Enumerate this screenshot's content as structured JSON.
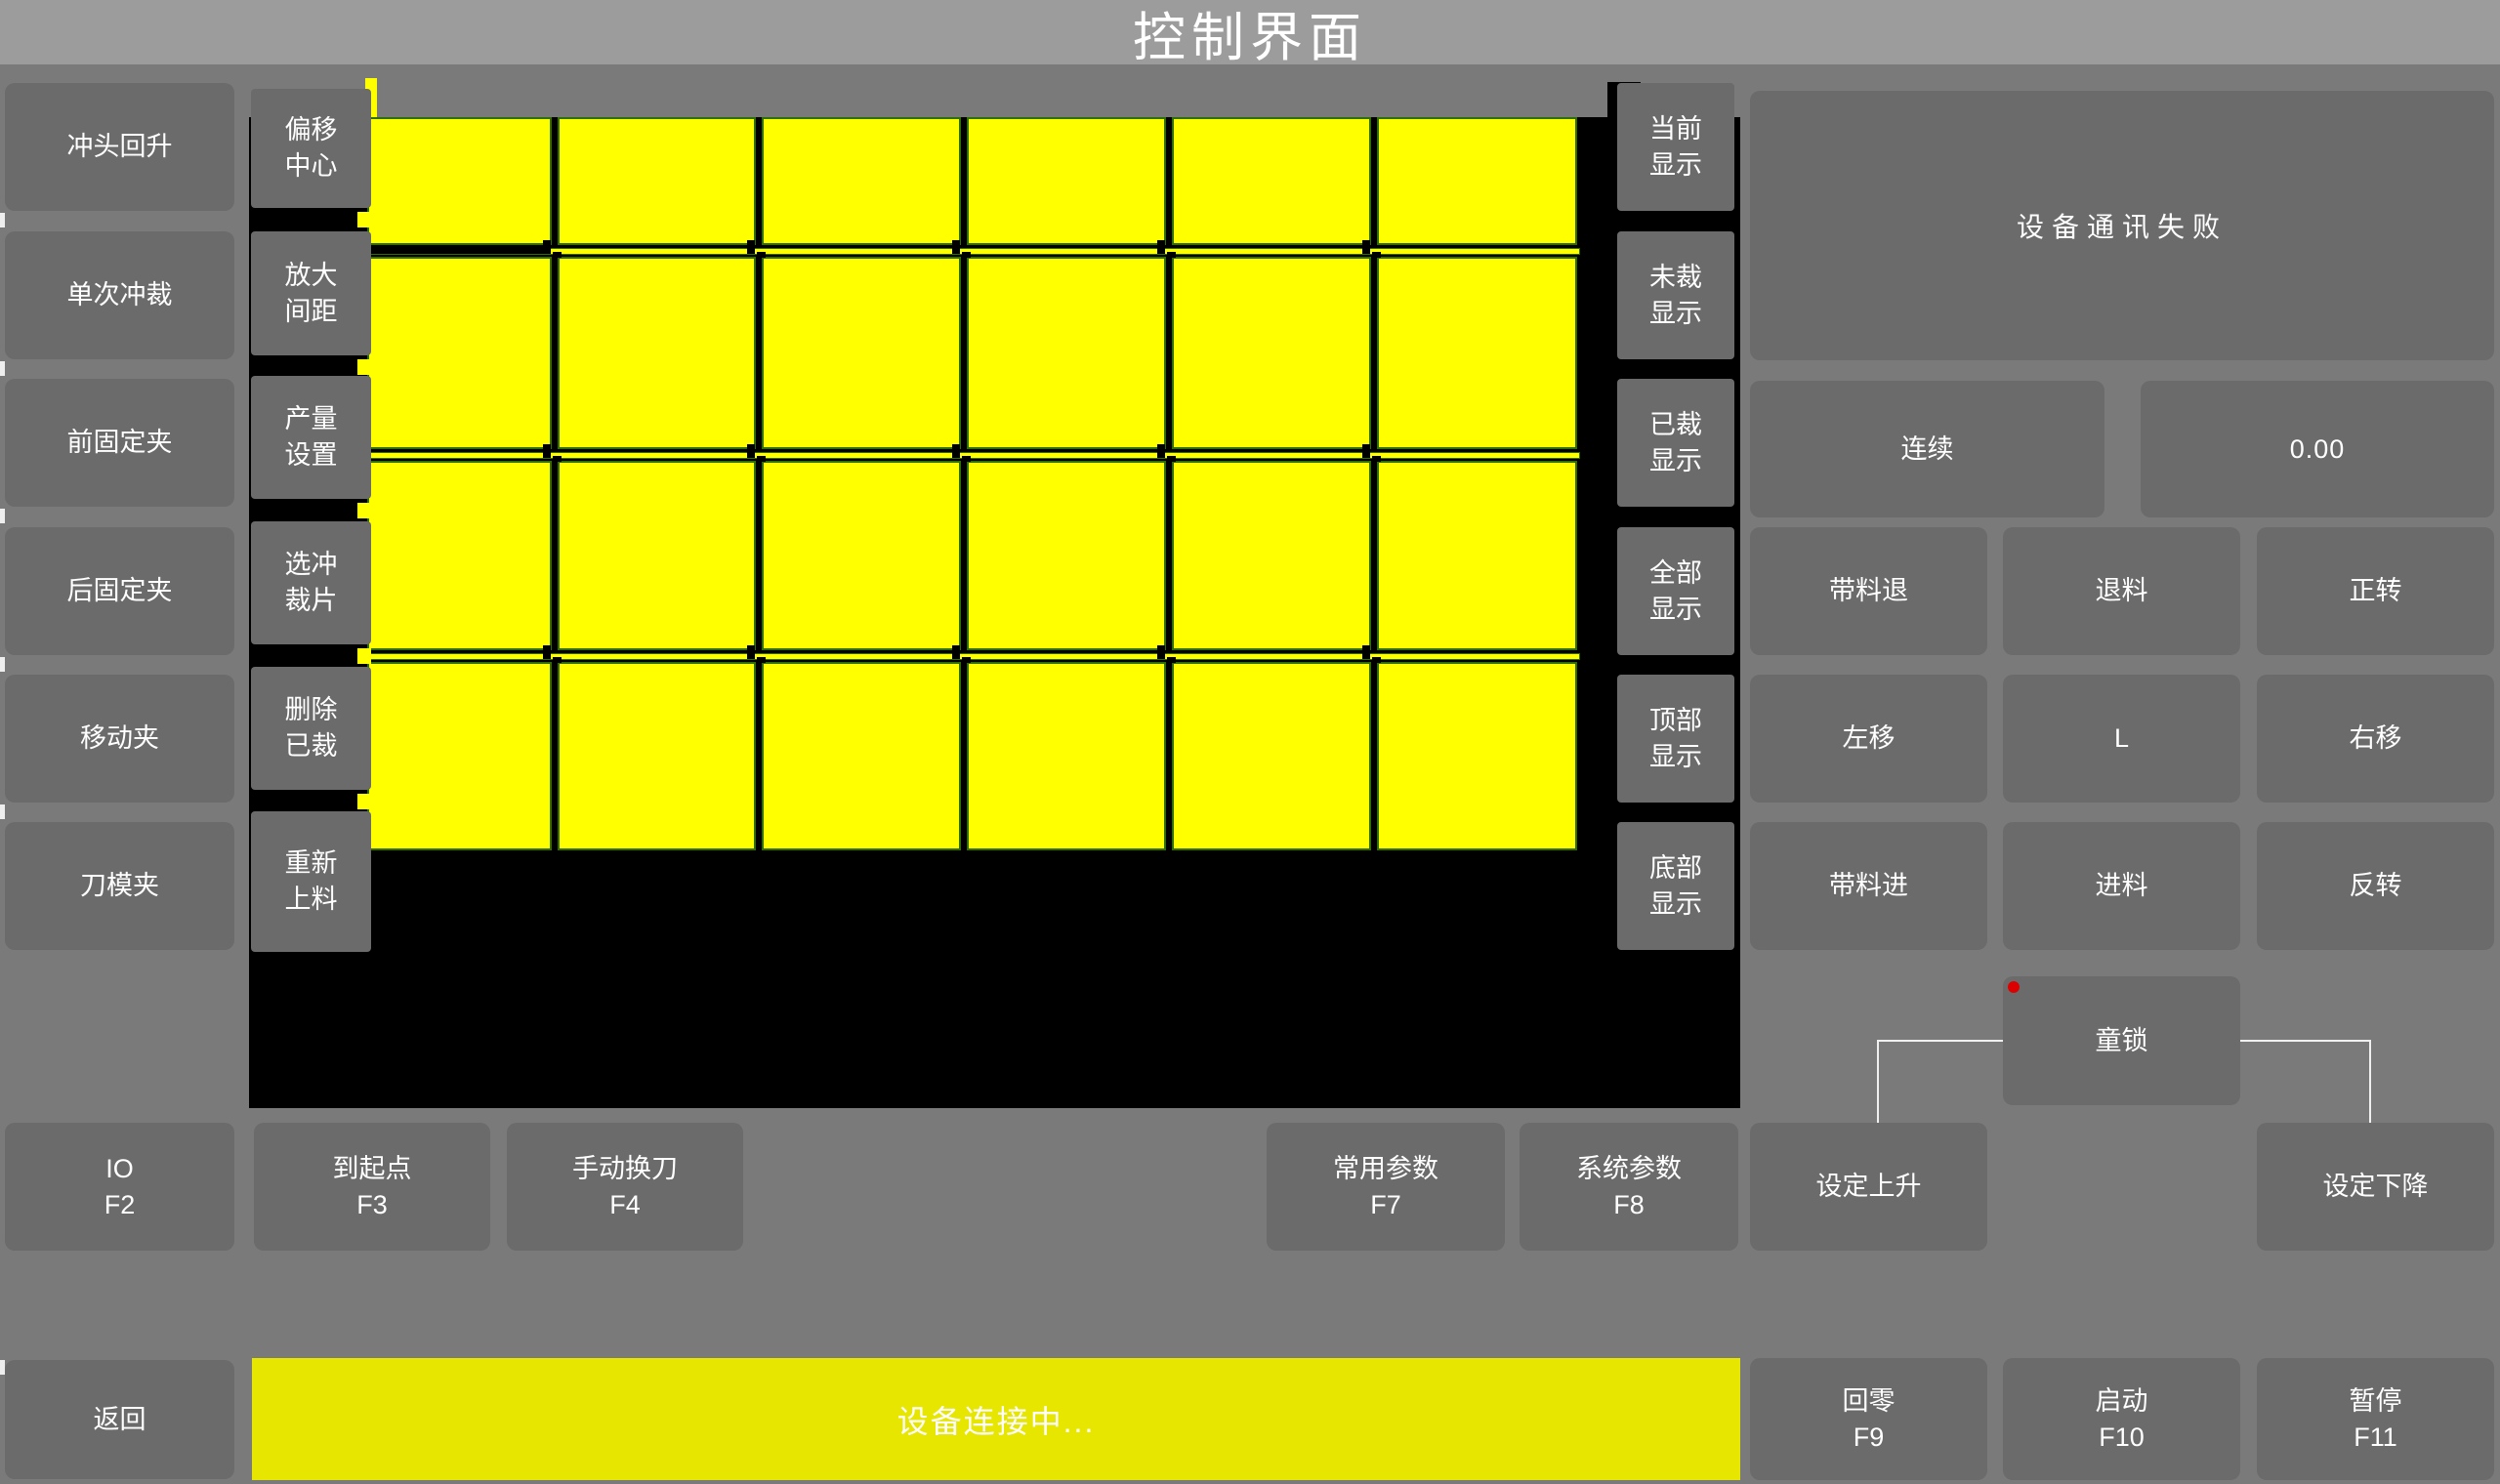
{
  "title": "控制界面",
  "colors": {
    "page": "#7a7a7a",
    "titlebar": "#9c9c9c",
    "button": "#6b6b6b",
    "sheet": "#000000",
    "piece_yellow": "#ffff00",
    "piece_border_green": "#2f6e00",
    "status_bar_yellow": "#e6e600",
    "red_dot": "#dd0000",
    "indicator_gray": "#b8b8b8",
    "bracket_white": "#f0f0f0",
    "text_white": "#ffffff"
  },
  "left_buttons": [
    {
      "label": "冲头回升",
      "indicator": false
    },
    {
      "label": "单次冲裁",
      "indicator": false
    },
    {
      "label": "前固定夹",
      "indicator": true
    },
    {
      "label": "后固定夹",
      "indicator": true
    },
    {
      "label": "移动夹",
      "indicator": true
    },
    {
      "label": "刀模夹",
      "indicator": true
    }
  ],
  "tool_buttons": [
    {
      "label": "偏移\n中心"
    },
    {
      "label": "放大\n间距"
    },
    {
      "label": "产量\n设置"
    },
    {
      "label": "选冲\n裁片"
    },
    {
      "label": "删除\n已裁"
    },
    {
      "label": "重新\n上料"
    }
  ],
  "display_buttons": [
    {
      "label": "当前\n显示"
    },
    {
      "label": "未裁\n显示"
    },
    {
      "label": "已裁\n显示"
    },
    {
      "label": "全部\n显示"
    },
    {
      "label": "顶部\n显示"
    },
    {
      "label": "底部\n显示"
    }
  ],
  "chart_data": {
    "type": "table",
    "title": "裁片排样画布",
    "grid_columns": 6,
    "grid_rows": 4,
    "piece_state": "未裁",
    "note": "6列×4行黄色裁片排布于黑色料板上"
  },
  "right_panel": {
    "message": "设备通讯失败",
    "mode_button": "连续",
    "value_display": "0.00",
    "motion_buttons": [
      [
        "带料退",
        "退料",
        "正转"
      ],
      [
        "左移",
        "L",
        "右移"
      ],
      [
        "带料进",
        "进料",
        "反转"
      ]
    ],
    "child_lock": "童锁"
  },
  "function_keys": [
    {
      "label": "IO",
      "key": "F2"
    },
    {
      "label": "到起点",
      "key": "F3"
    },
    {
      "label": "手动换刀",
      "key": "F4"
    },
    {
      "label": "常用参数",
      "key": "F7"
    },
    {
      "label": "系统参数",
      "key": "F8"
    }
  ],
  "set_buttons": {
    "up": "设定上升",
    "down": "设定下降"
  },
  "bottom_bar": {
    "back": "返回",
    "status": "设备连接中...",
    "keys": [
      {
        "label": "回零",
        "key": "F9"
      },
      {
        "label": "启动",
        "key": "F10"
      },
      {
        "label": "暂停",
        "key": "F11"
      }
    ]
  }
}
